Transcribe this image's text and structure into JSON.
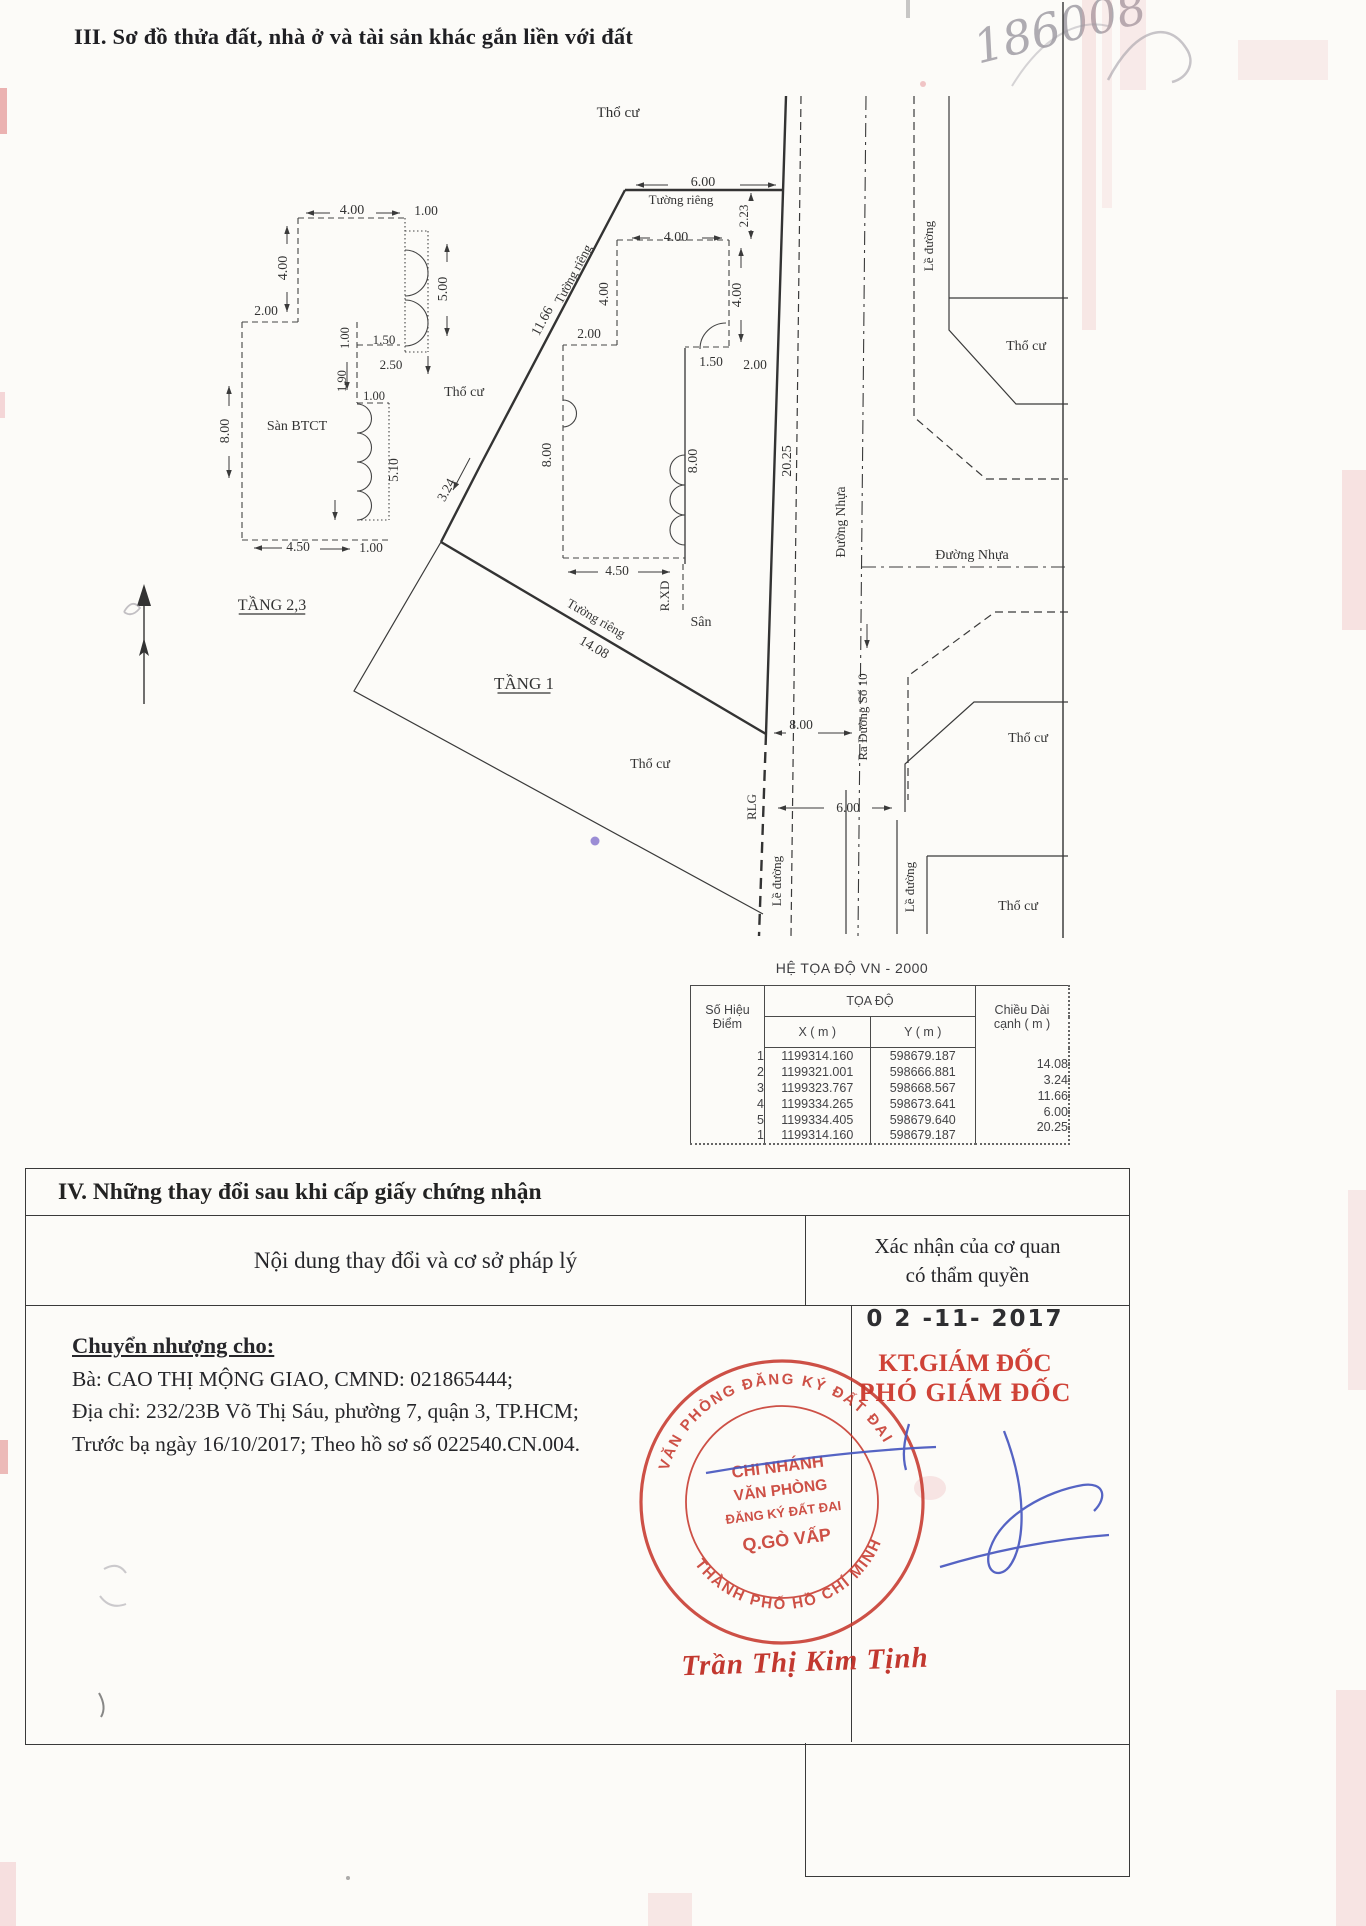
{
  "page": {
    "section3_title": "III. Sơ đồ thửa đất, nhà ở và tài sản khác gắn liền với đất",
    "handwritten_number": "186008"
  },
  "colors": {
    "ink": "#2b2b2b",
    "stamp_red": "#c7392e",
    "signature_blue": "#4757bf",
    "name_red": "#c2382f",
    "pencil_gray": "#9b98a0"
  },
  "diagram": {
    "labels": [
      {
        "t": "Thổ cư",
        "x": 618,
        "y": 117,
        "s": 15
      },
      {
        "t": "6.00",
        "x": 703,
        "y": 186,
        "s": 14
      },
      {
        "t": "Tường riêng",
        "x": 681,
        "y": 204,
        "s": 13
      },
      {
        "t": "2.23",
        "x": 748,
        "y": 216,
        "r": -90,
        "s": 13
      },
      {
        "t": "4.00",
        "x": 676,
        "y": 241,
        "s": 14
      },
      {
        "t": "4.00",
        "x": 741,
        "y": 295,
        "r": -90,
        "s": 14
      },
      {
        "t": "1.50",
        "x": 711,
        "y": 366,
        "s": 13.5
      },
      {
        "t": "2.00",
        "x": 755,
        "y": 369,
        "s": 13.5
      },
      {
        "t": "8.00",
        "x": 697,
        "y": 461,
        "r": -90,
        "s": 14
      },
      {
        "t": "20.25",
        "x": 791,
        "y": 461,
        "r": -90,
        "s": 14
      },
      {
        "t": "Đường Nhựa",
        "x": 845,
        "y": 522,
        "r": -90,
        "s": 13.5
      },
      {
        "t": "Lề đường",
        "x": 933,
        "y": 246,
        "r": -90,
        "s": 13
      },
      {
        "t": "Thổ cư",
        "x": 1026,
        "y": 350,
        "s": 14
      },
      {
        "t": "Đường Nhựa",
        "x": 972,
        "y": 559,
        "s": 14
      },
      {
        "t": "Tường riêng",
        "x": 577,
        "y": 276,
        "r": -62,
        "s": 13
      },
      {
        "t": "11.66",
        "x": 546,
        "y": 323,
        "r": -62,
        "s": 14
      },
      {
        "t": "2.00",
        "x": 589,
        "y": 338,
        "s": 13.5
      },
      {
        "t": "4.00",
        "x": 608,
        "y": 294,
        "r": -90,
        "s": 13.5
      },
      {
        "t": "8.00",
        "x": 551,
        "y": 455,
        "r": -90,
        "s": 14
      },
      {
        "t": "Thổ cư",
        "x": 464,
        "y": 396,
        "s": 14
      },
      {
        "t": "3.24",
        "x": 450,
        "y": 492,
        "r": -62,
        "s": 13.5
      },
      {
        "t": "Tường riêng",
        "x": 594,
        "y": 622,
        "r": 30,
        "s": 13
      },
      {
        "t": "14.08",
        "x": 592,
        "y": 651,
        "r": 30,
        "s": 14
      },
      {
        "t": "4.50",
        "x": 617,
        "y": 575,
        "s": 13.5
      },
      {
        "t": "R.XD",
        "x": 669,
        "y": 596,
        "r": -90,
        "s": 13
      },
      {
        "t": "Sân",
        "x": 701,
        "y": 626,
        "s": 14
      },
      {
        "t": "TẦNG 1",
        "x": 524,
        "y": 689,
        "s": 17,
        "u": true
      },
      {
        "t": "Thổ cư",
        "x": 650,
        "y": 768,
        "s": 14
      },
      {
        "t": "8.00",
        "x": 801,
        "y": 729,
        "s": 13.5
      },
      {
        "t": "RLG",
        "x": 756,
        "y": 807,
        "r": -90,
        "s": 13
      },
      {
        "t": "6.00",
        "x": 848,
        "y": 812,
        "s": 13.5
      },
      {
        "t": "Lề đường",
        "x": 781,
        "y": 881,
        "r": -90,
        "s": 13
      },
      {
        "t": "Ra Đường Số 10",
        "x": 867,
        "y": 717,
        "r": -90,
        "s": 13
      },
      {
        "t": "Thổ cư",
        "x": 1028,
        "y": 742,
        "s": 14
      },
      {
        "t": "Lề đường",
        "x": 914,
        "y": 887,
        "r": -90,
        "s": 13
      },
      {
        "t": "Thổ cư",
        "x": 1018,
        "y": 910,
        "s": 14
      },
      {
        "t": "4.00",
        "x": 352,
        "y": 214,
        "s": 14
      },
      {
        "t": "1.00",
        "x": 426,
        "y": 215,
        "s": 13.5
      },
      {
        "t": "4.00",
        "x": 287,
        "y": 268,
        "r": -90,
        "s": 14
      },
      {
        "t": "5.00",
        "x": 447,
        "y": 289,
        "r": -90,
        "s": 14
      },
      {
        "t": "2.00",
        "x": 266,
        "y": 315,
        "s": 13.5
      },
      {
        "t": "1.50",
        "x": 384,
        "y": 344,
        "s": 13
      },
      {
        "t": "2.50",
        "x": 391,
        "y": 369,
        "s": 13
      },
      {
        "t": "1.00",
        "x": 349,
        "y": 338,
        "r": -90,
        "s": 12.5
      },
      {
        "t": "1.90",
        "x": 346,
        "y": 381,
        "r": -90,
        "s": 12.5
      },
      {
        "t": "1.00",
        "x": 374,
        "y": 400,
        "s": 12.5
      },
      {
        "t": "8.00",
        "x": 229,
        "y": 431,
        "r": -90,
        "s": 14
      },
      {
        "t": "Sàn BTCT",
        "x": 297,
        "y": 430,
        "s": 14
      },
      {
        "t": "5.10",
        "x": 398,
        "y": 470,
        "r": -90,
        "s": 13.5
      },
      {
        "t": "4.50",
        "x": 298,
        "y": 551,
        "s": 13.5
      },
      {
        "t": "1.00",
        "x": 371,
        "y": 552,
        "s": 13.5
      },
      {
        "t": "TẦNG 2,3",
        "x": 272,
        "y": 610,
        "s": 16,
        "u": true
      }
    ]
  },
  "coord_table": {
    "title": "HỆ TỌA ĐỘ VN - 2000",
    "h_point1": "Số Hiệu",
    "h_point2": "Điểm",
    "h_group": "TỌA ĐỘ",
    "h_x": "X ( m )",
    "h_y": "Y ( m )",
    "h_len1": "Chiều Dài",
    "h_len2": "cạnh ( m )",
    "rows": [
      {
        "p": "1",
        "x": "1199314.160",
        "y": "598679.187"
      },
      {
        "p": "2",
        "x": "1199321.001",
        "y": "598666.881"
      },
      {
        "p": "3",
        "x": "1199323.767",
        "y": "598668.567"
      },
      {
        "p": "4",
        "x": "1199334.265",
        "y": "598673.641"
      },
      {
        "p": "5",
        "x": "1199334.405",
        "y": "598679.640"
      },
      {
        "p": "1",
        "x": "1199314.160",
        "y": "598679.187"
      }
    ],
    "lengths": [
      "14.08",
      "3.24",
      "11.66",
      "6.00",
      "20.25"
    ]
  },
  "section4": {
    "title": "IV. Những thay đổi sau khi cấp giấy chứng nhận",
    "col_left": "Nội dung thay đổi và cơ sở pháp lý",
    "col_right_1": "Xác nhận của cơ quan",
    "col_right_2": "có thẩm quyền",
    "transfer_heading": "Chuyển nhượng cho:",
    "line1": "Bà: CAO THỊ MỘNG GIAO, CMND: 021865444;",
    "line2": "Địa chỉ: 232/23B Võ Thị Sáu, phường 7, quận 3, TP.HCM;",
    "line3": "Trước bạ ngày 16/10/2017; Theo hồ sơ số 022540.CN.004.",
    "date_stamp": "0 2 -11- 2017",
    "approver_title1": "KT.GIÁM ĐỐC",
    "approver_title2": "PHÓ GIÁM ĐỐC",
    "signer_name": "Trần Thị Kim Tịnh",
    "stamp": {
      "ring_top": "VĂN PHÒNG ĐĂNG KÝ ĐẤT ĐAI",
      "ring_bottom": "THÀNH PHỐ HỒ CHÍ MINH",
      "center1": "CHI NHÁNH",
      "center2": "VĂN PHÒNG",
      "center3": "ĐĂNG KÝ ĐẤT ĐAI",
      "center4": "Q.GÒ VẤP"
    }
  }
}
